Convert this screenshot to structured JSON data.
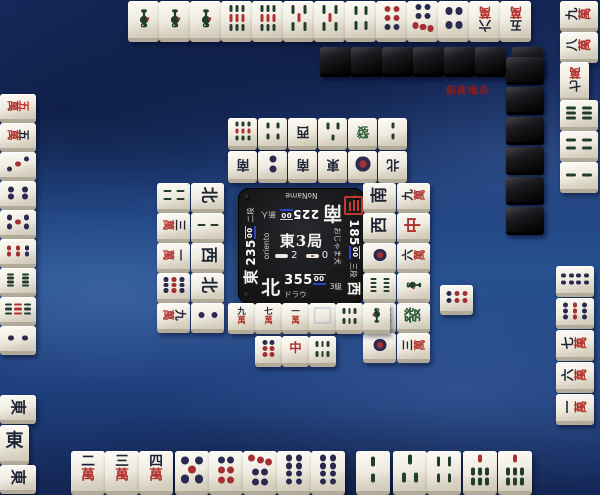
{
  "badge": {
    "text": "般南喰赤",
    "color": "#8c1d1d"
  },
  "center_panel": {
    "round": "東3局",
    "sticks": {
      "honba": "2",
      "riichi": "0"
    },
    "players": {
      "bottom": {
        "wind": "北",
        "score": "355",
        "score_small": "00",
        "name": "ドラウ",
        "rank": "3級"
      },
      "right": {
        "wind": "東",
        "score": "235",
        "score_small": "00",
        "name": "oriento",
        "rank": "二段"
      },
      "top": {
        "wind": "南",
        "score": "225",
        "score_small": "00",
        "name": "NoName",
        "rank": "新人"
      },
      "left": {
        "wind": "西",
        "score": "185",
        "score_small": "00",
        "name": "おじゃま犬",
        "rank": "三段",
        "has_seal": true
      }
    }
  },
  "colors": {
    "score_underline_blue": "#2b46c8",
    "seal_red": "#c23a2e",
    "pin_navy": "#2a2a50",
    "pin_red": "#a42f33",
    "sou_green": "#24413100",
    "sou_dark": "#223d2e",
    "man_dark": "#1e2433",
    "man_red": "#b0302c",
    "dragon_green": "#2c5a35",
    "dragon_red": "#b0302c",
    "red_five": "#c03028"
  },
  "tile_code_legend": {
    "m": "characters (萬)",
    "p": "circles (筒)",
    "s": "bamboo (索)",
    "0m": "red five man",
    "E": "東",
    "S": "南",
    "W": "西",
    "N": "北",
    "P": "白",
    "F": "發",
    "C": "中",
    "X": "face-down back",
    "!": "turned called tile"
  },
  "tiles": {
    "bottom_hand": [
      "2m",
      "3m",
      "4m",
      "5p",
      "6p",
      "7p",
      "8p",
      "8p",
      "2s",
      "3s",
      "4s",
      "7s",
      "7s"
    ],
    "top_hand": [
      "1s",
      "1s",
      "1s",
      "9s",
      "9s",
      "5s",
      "5s",
      "4s",
      "6p",
      "7p",
      "4p",
      "6m",
      "5m"
    ],
    "left_hand": [
      "0m",
      "5m",
      "3p",
      "4p",
      "5p",
      "6p",
      "8s",
      "9s",
      "2p"
    ],
    "left_meld": [
      "E",
      "E!",
      "E"
    ],
    "right_hand_upper": [
      "9m",
      "8m",
      "7m!",
      "6s",
      "4s",
      "2s"
    ],
    "right_hand_lower": [
      "8p",
      "9p",
      "7m",
      "6m",
      "1m"
    ],
    "wall_top": [
      "X",
      "X",
      "X",
      "X",
      "X",
      "X",
      "X"
    ],
    "wall_right": [
      "X",
      "X",
      "X",
      "X",
      "X",
      "X"
    ],
    "discard_top_far": [
      "9s",
      "4s",
      "W",
      "3s",
      "F",
      "2s"
    ],
    "discard_top_near": [
      "S",
      "2p",
      "S",
      "E",
      "1p",
      "N"
    ],
    "discard_left_outer": [
      "4s",
      "3m",
      "1m",
      "9p",
      "9m"
    ],
    "discard_left_inner": [
      "N",
      "2s",
      "W",
      "N",
      "2p"
    ],
    "discard_right_inner": [
      "S",
      "W",
      "1p",
      "8s",
      "9p",
      "1p"
    ],
    "discard_right_outer": [
      "9m",
      "C",
      "6m",
      "1s",
      "F",
      "3m"
    ],
    "discard_right_extra": [
      "6p"
    ],
    "discard_bottom_row1": [
      "9m",
      "7m",
      "1m",
      "P",
      "6s",
      "1s"
    ],
    "discard_bottom_row2": [
      "6p",
      "C",
      "6s"
    ]
  }
}
